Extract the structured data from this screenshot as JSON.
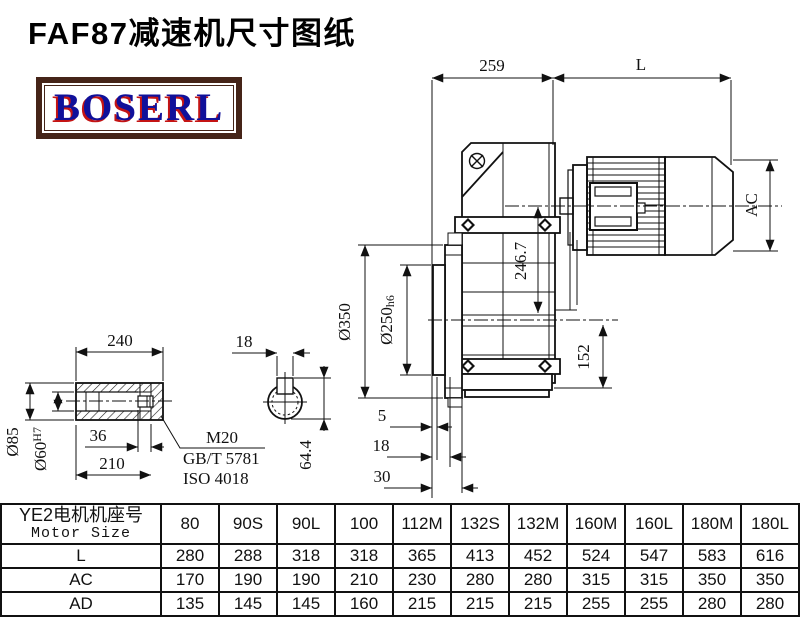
{
  "title": "FAF87减速机尺寸图纸",
  "logo": {
    "text": "BOSERL",
    "border_color": "#452418",
    "text_color": "#10109a",
    "shadow_color": "#c41414"
  },
  "drawing": {
    "dims": {
      "d259": "259",
      "dL": "L",
      "dAC": "AC",
      "d246": "246.7",
      "d350": "Ø350",
      "d250": "Ø250",
      "d250t": "h6",
      "d152": "152",
      "d5": "5",
      "d18f": "18",
      "d30": "30",
      "d240": "240",
      "d18k": "18",
      "d85": "Ø85",
      "d60": "Ø60",
      "d60t": "H7",
      "d36": "36",
      "d210": "210",
      "d644": "64.4",
      "m20": "M20",
      "gb": "GB/T 5781",
      "iso": "ISO 4018"
    }
  },
  "table": {
    "header_cn": "YE2电机机座号",
    "header_en": "Motor Size",
    "columns": [
      "80",
      "90S",
      "90L",
      "100",
      "112M",
      "132S",
      "132M",
      "160M",
      "160L",
      "180M",
      "180L"
    ],
    "rows": [
      {
        "label": "L",
        "values": [
          "280",
          "288",
          "318",
          "318",
          "365",
          "413",
          "452",
          "524",
          "547",
          "583",
          "616"
        ]
      },
      {
        "label": "AC",
        "values": [
          "170",
          "190",
          "190",
          "210",
          "230",
          "280",
          "280",
          "315",
          "315",
          "350",
          "350"
        ]
      },
      {
        "label": "AD",
        "values": [
          "135",
          "145",
          "145",
          "160",
          "215",
          "215",
          "215",
          "255",
          "255",
          "280",
          "280"
        ]
      }
    ]
  }
}
